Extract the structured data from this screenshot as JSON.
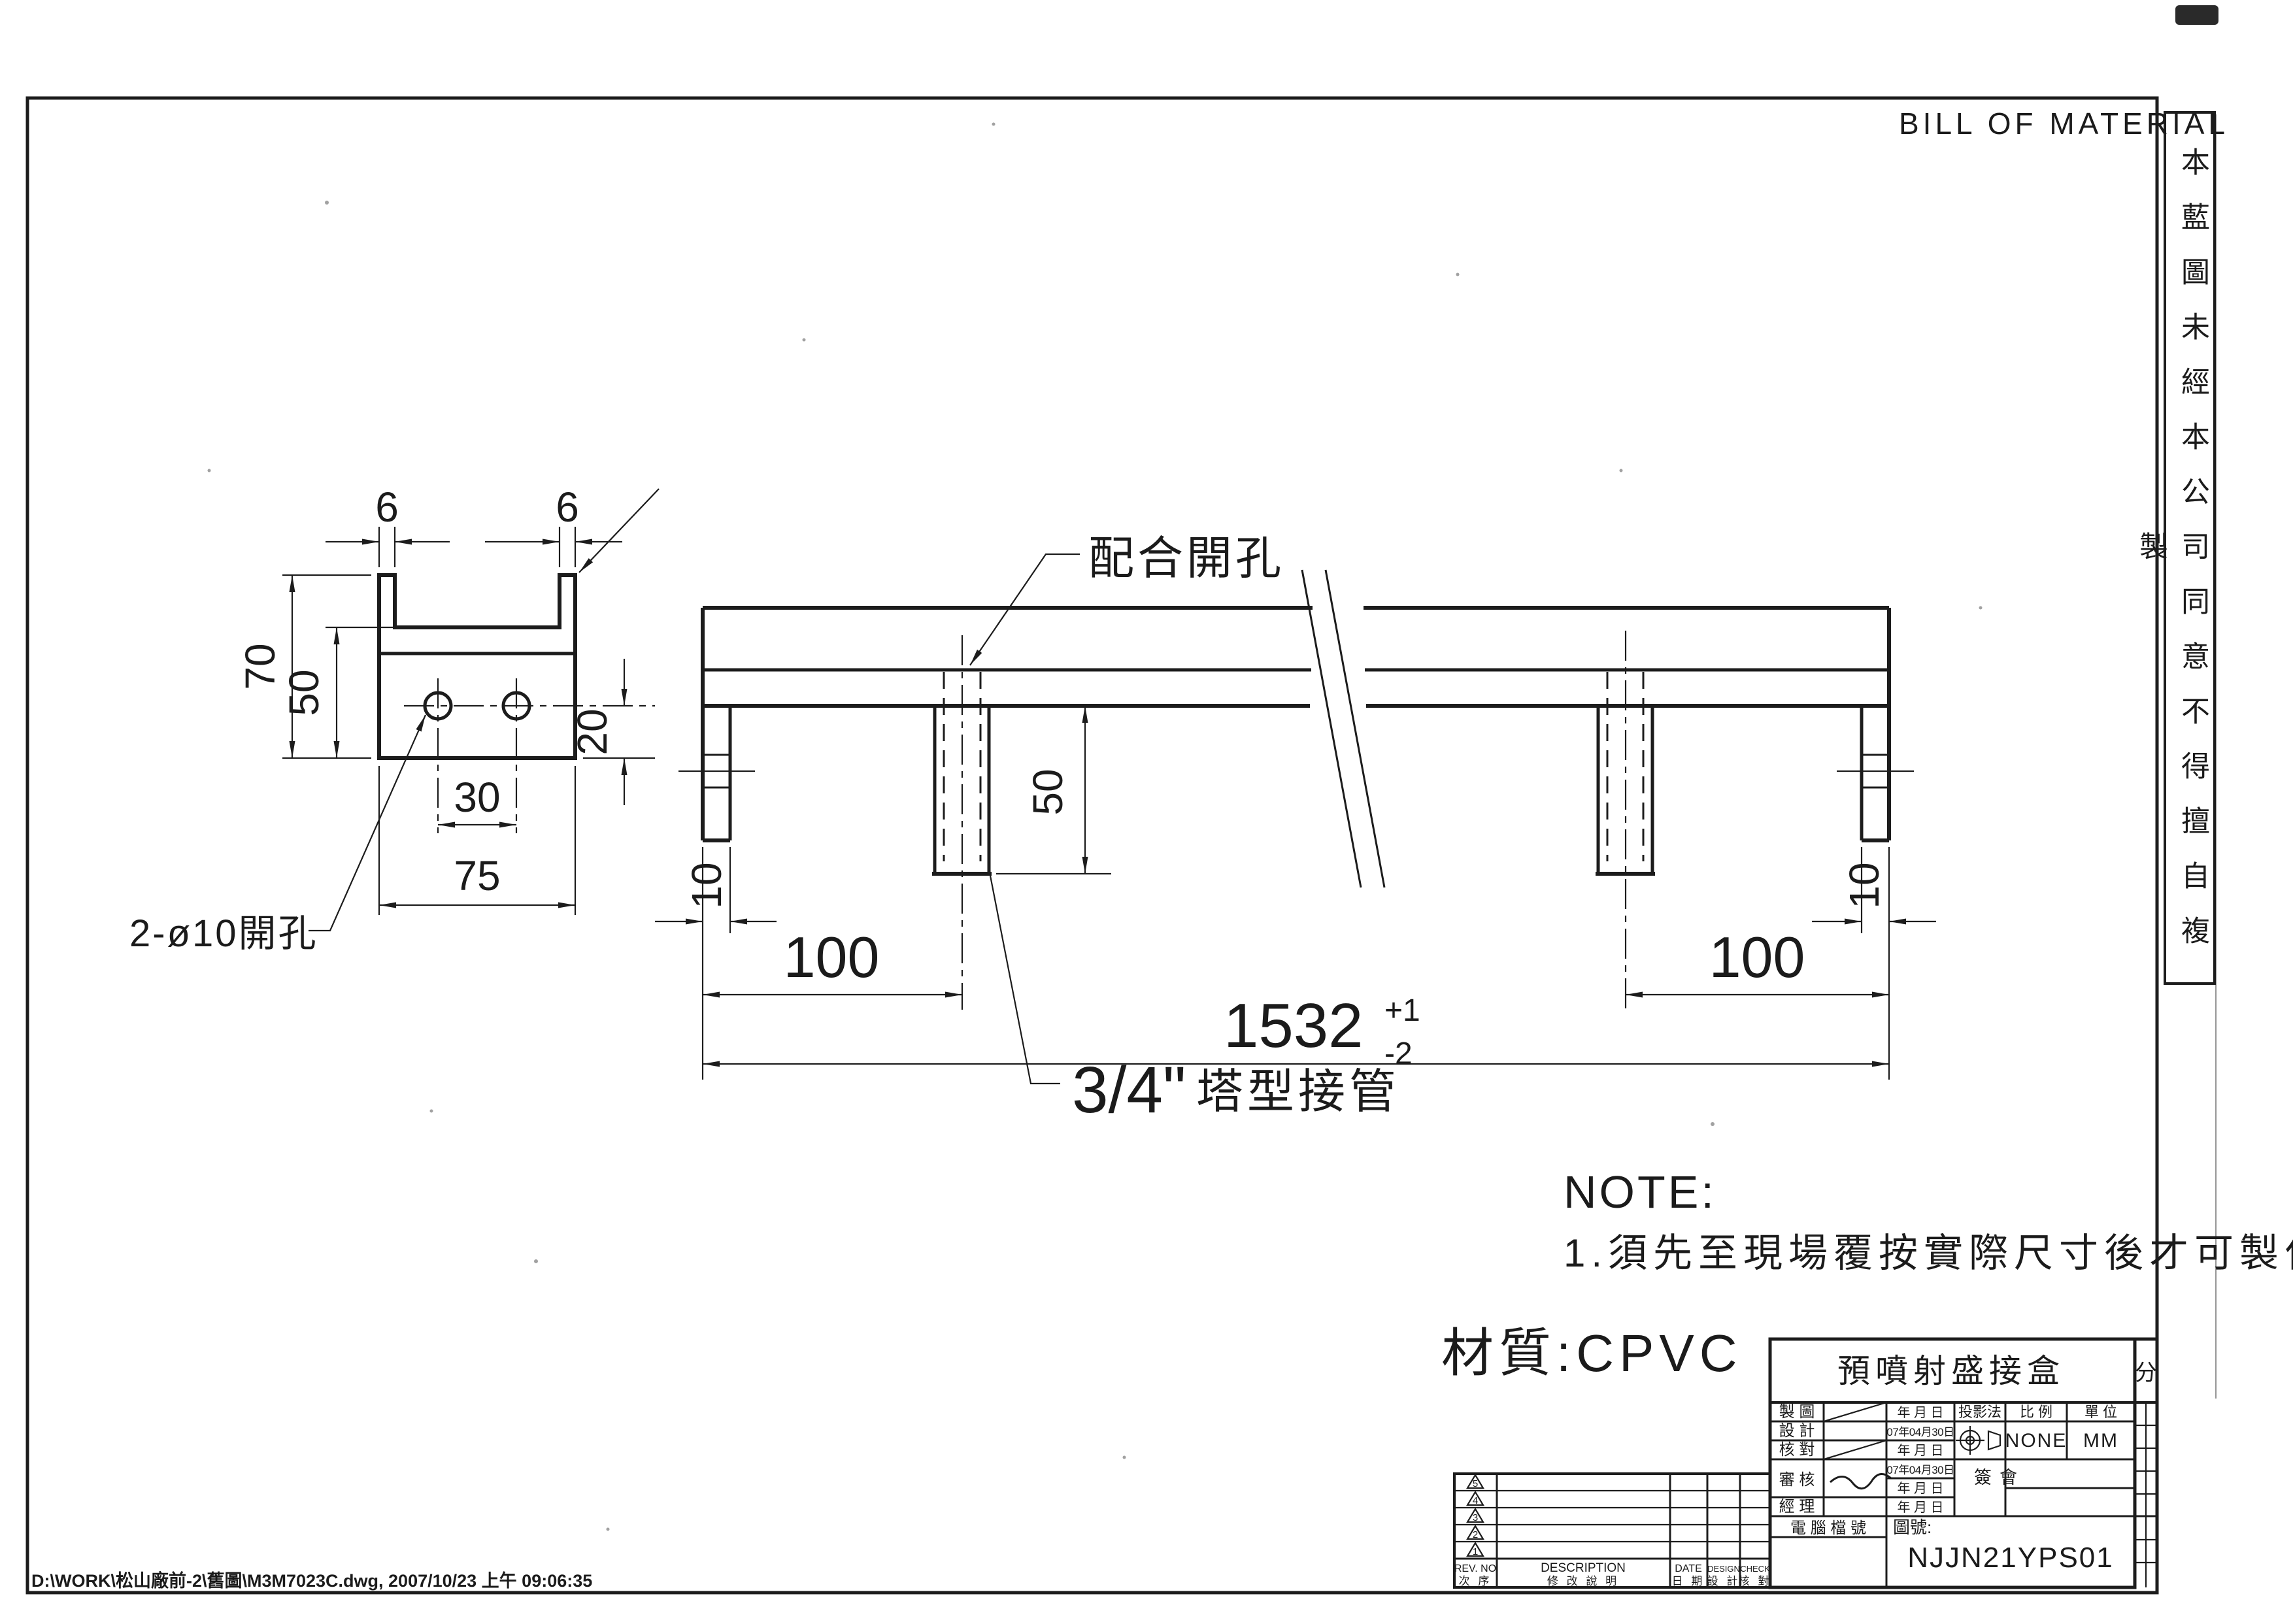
{
  "colors": {
    "ink": "#1c1c1c",
    "paper": "#ffffff"
  },
  "header": {
    "bom_label": "BILL OF MATERIAL"
  },
  "side_strip": {
    "notice": "本藍圖未經本公司同意不得擅自複製"
  },
  "section_view": {
    "dim_flange_left": "6",
    "dim_flange_right": "6",
    "dim_height": "70",
    "dim_inner": "50",
    "dim_hole_offset": "20",
    "dim_hole_spacing": "30",
    "dim_width": "75",
    "hole_label": "2-ø10開孔"
  },
  "main_view": {
    "fit_hole_label": "配合開孔",
    "pipe_size": "3/4\"",
    "pipe_label": "塔型接管",
    "dim_tube_len": "50",
    "dim_left_span": "100",
    "dim_right_span": "100",
    "dim_tab_left": "10",
    "dim_tab_right": "10",
    "dim_total": "1532",
    "tol_upper": "+1",
    "tol_lower": "-2"
  },
  "note": {
    "heading": "NOTE:",
    "line1": "1.須先至現場覆按實際尺寸後才可製作."
  },
  "material": {
    "label": "材質:CPVC"
  },
  "title_block": {
    "title": "預噴射盛接盒",
    "labels": {
      "draw": "製 圖",
      "design": "設 計",
      "check": "核 對",
      "review": "審 核",
      "manager": "經 理",
      "file_no": "電 腦 檔 號",
      "drawing_no_label": "圖號:"
    },
    "col_headers": {
      "date": "年 月 日",
      "projection": "投影法",
      "scale": "比 例",
      "unit": "單 位"
    },
    "dates": {
      "design": "07年04月30日",
      "check": "年 月 日",
      "review_1": "07年04月30日",
      "review_2": "年 月 日",
      "manager": "年 月 日"
    },
    "scale_value": "NONE",
    "unit_value": "MM",
    "countersign": "會簽",
    "drawing_no": "NJJN21YPS01",
    "dist_label": "分"
  },
  "rev_table": {
    "headers": {
      "rev_en": "REV. NO",
      "rev_zh": "次 序",
      "desc_en": "DESCRIPTION",
      "desc_zh": "修 改 說 明",
      "date_en": "DATE",
      "date_zh": "日 期",
      "design_en": "DESIGN",
      "design_zh": "設 計",
      "check_en": "CHECK",
      "check_zh": "核 對"
    },
    "rev_marks": [
      "5",
      "4",
      "3",
      "2",
      "1"
    ]
  },
  "footer": {
    "file_path": "D:\\WORK\\松山廠前-2\\舊圖\\M3M7023C.dwg, 2007/10/23 上午 09:06:35"
  }
}
